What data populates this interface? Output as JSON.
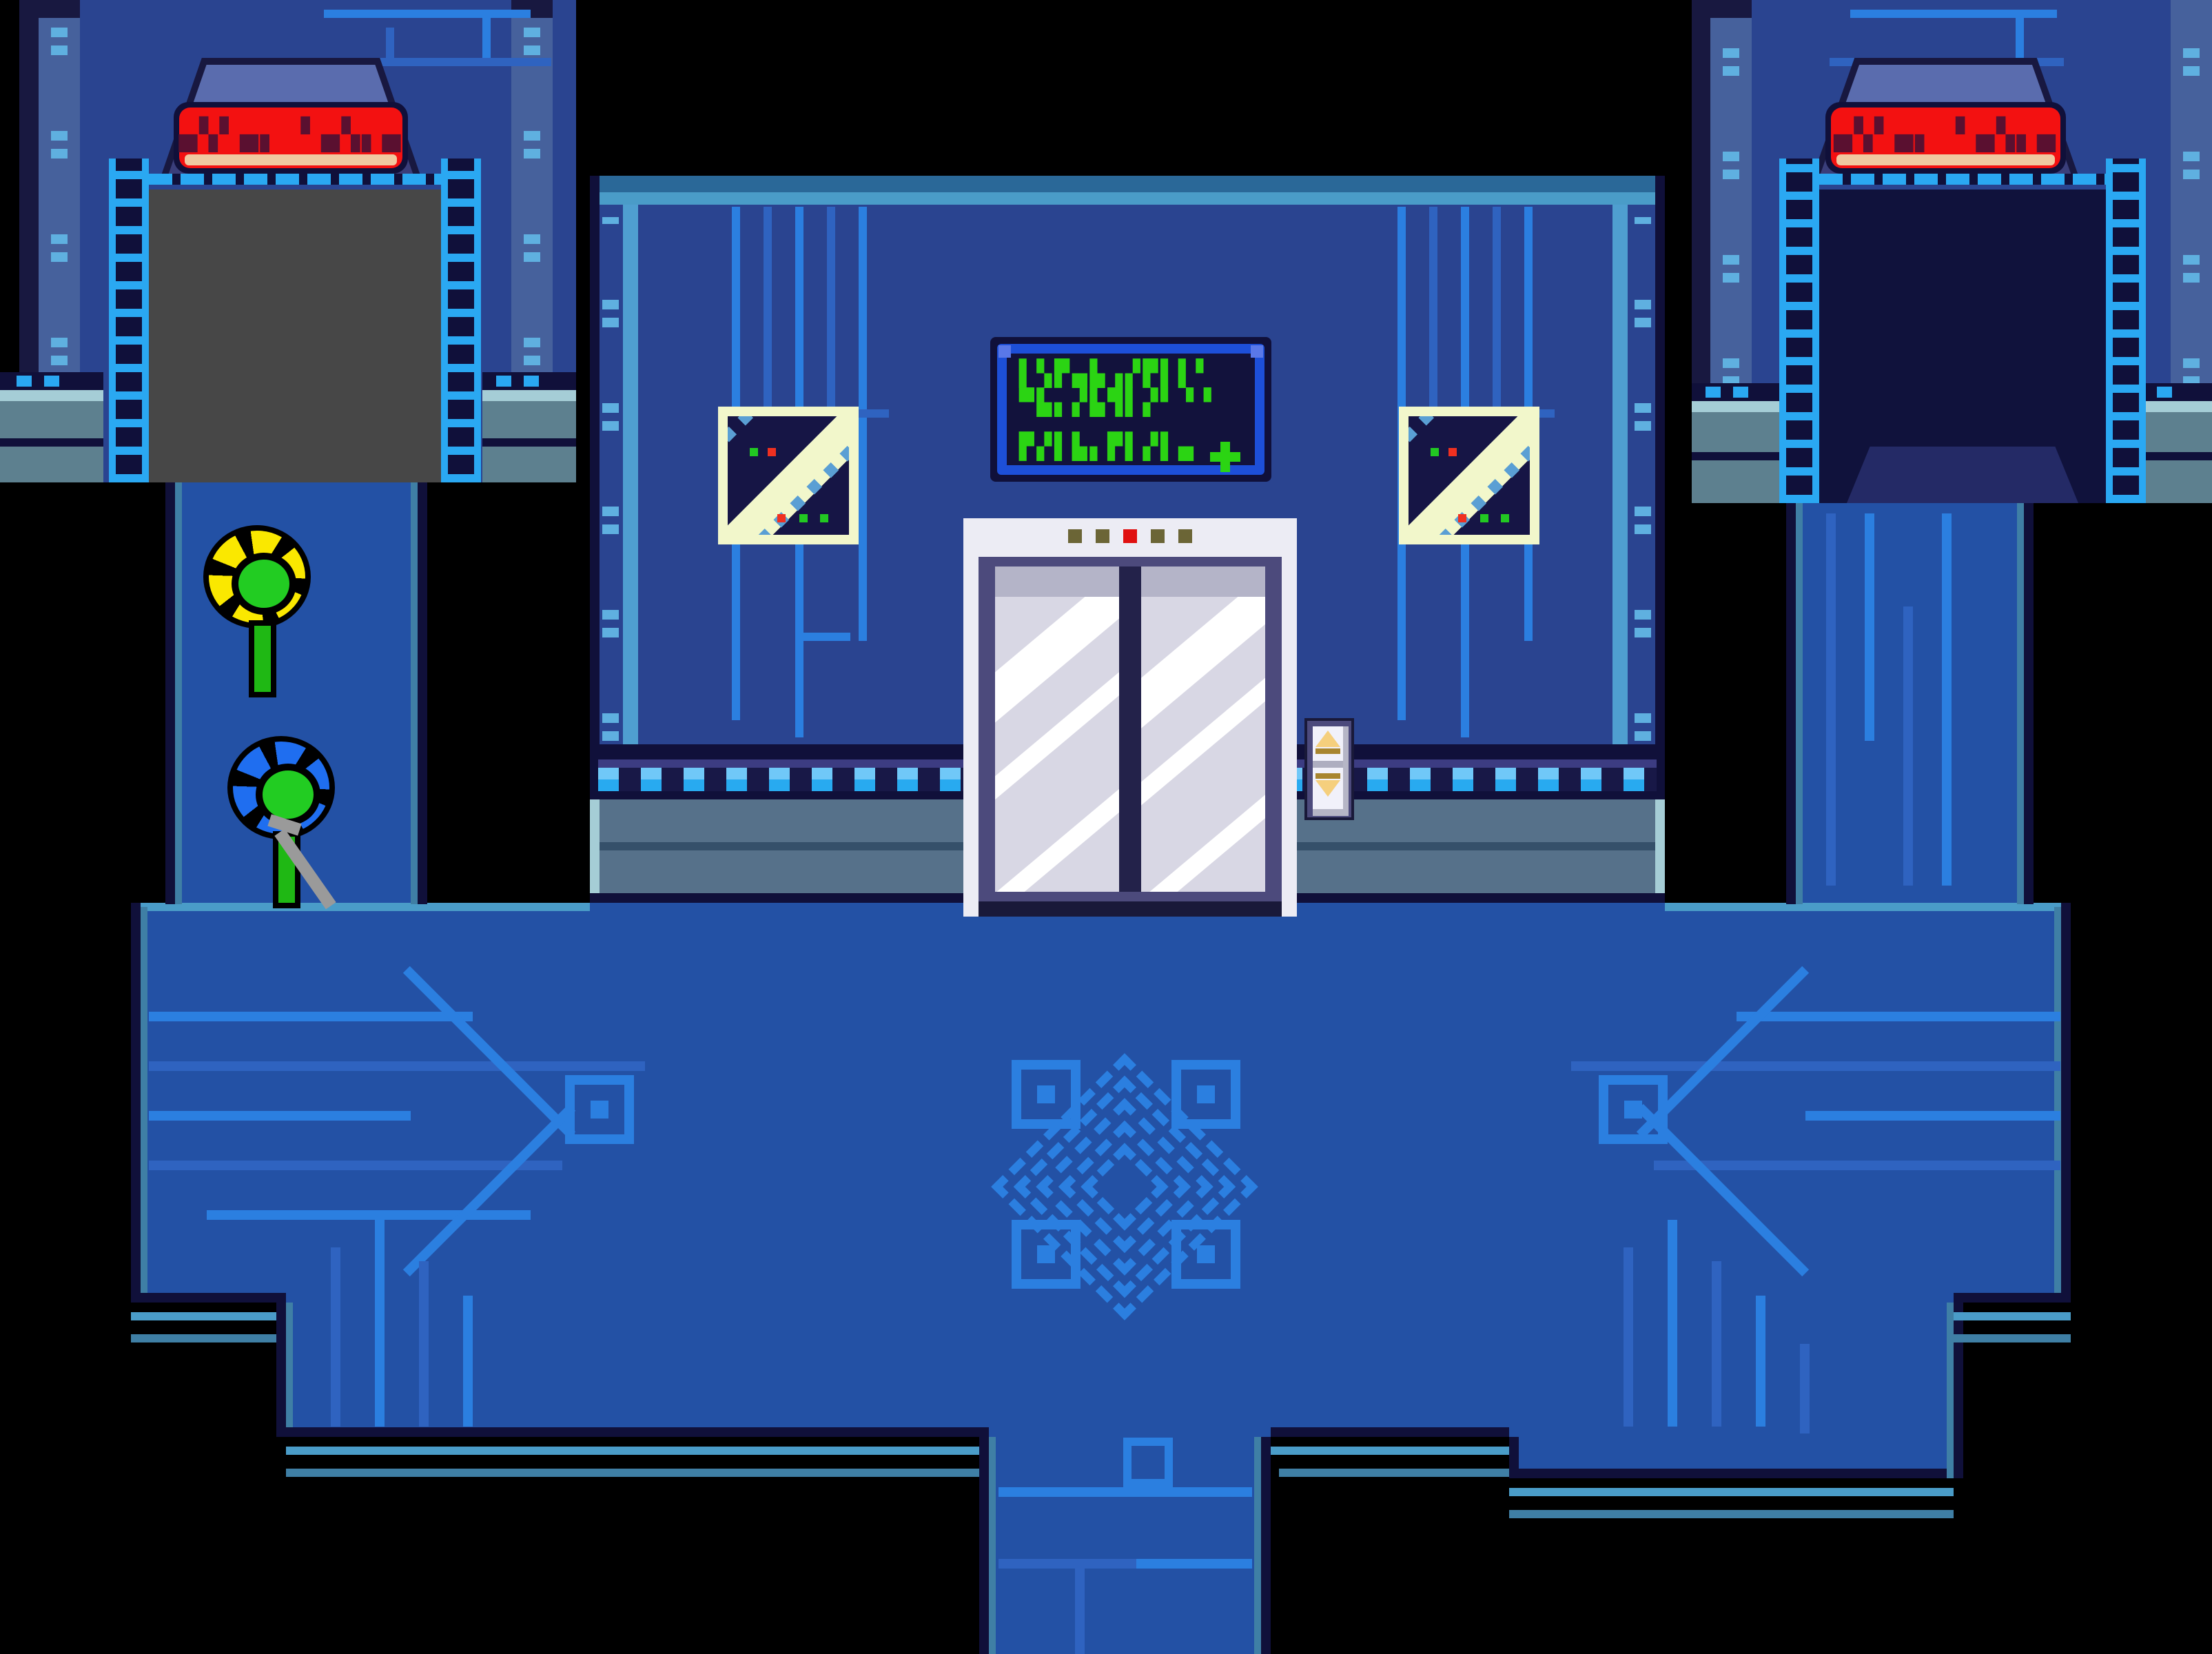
{
  "palette": {
    "bg": "#000000",
    "floor": "#2351a5",
    "trace": "#2b7fe0",
    "trace_dim": "#2f63c0",
    "edge_navy": "#10103a",
    "edge_teal": "#3f7fa5",
    "edge_light": "#4a9cc8",
    "wall": "#2a4490",
    "wall_top": "#2a6898",
    "pipe": "#4f9fd0",
    "pillar": "#46619c",
    "pillar_dark": "#181840",
    "rivet": "#5fb0e0",
    "arch_hi": "#5a6cae",
    "arch_mid": "#4a4e8e",
    "arch_lo": "#3a3e7a",
    "key_cyan": "#2aa8f2",
    "sign_red": "#f31111",
    "sign_glyph": "#5a1030",
    "sign_rim": "#f0c8a0",
    "door_gray": "#474747",
    "door_dark": "#10123c",
    "ramp": "#242a66",
    "term_border": "#1d4fd8",
    "term_screen": "#12123c",
    "term_green": "#2bd413",
    "win_frame": "#f2f7cb",
    "win_dark": "#161545",
    "win_blue": "#5a9fd4",
    "led_green": "#22c822",
    "led_red": "#f03020",
    "elev_frame": "#ececf4",
    "elev_purple": "#4c4a7c",
    "elev_panel": "#d8d7e4",
    "elev_panel_top": "#b4b4c8",
    "elev_gap": "#23224a",
    "shine": "#ffffff",
    "dot_olive": "#6b6536",
    "dot_red": "#e01010",
    "gold": "#f5cf7d",
    "gold_dark": "#a8852f",
    "btn_gray": "#aeaec0",
    "panel_white": "#f1f1fa",
    "trim_purple": "#3c3c82",
    "trim_navy": "#181847",
    "sq_hi": "#70c8f8",
    "sq_lo": "#28aaf0",
    "slate": "#56718a",
    "slate_dark": "#35506a",
    "slate_cap": "#a5cdd6",
    "base_slate": "#5d808f",
    "flower_yellow": "#fae800",
    "flower_blue": "#1f6ef0",
    "flower_green": "#22cc22",
    "stem_green": "#1fb814",
    "wrench_gray": "#9a9a9a"
  },
  "signs": {
    "led_text": "▄▚▘▄▖ ▘▄▚▖▄"
  },
  "terminal": {
    "lines": [
      "▌▚▛▄▙▗▞▛▌▌▘",
      "▀▙▖▞▙▜▌▞▘▝▝",
      "▛▞▌▙▖▛▌▞▌▄"
    ]
  },
  "elevator": {
    "indicator_dots": [
      "olive",
      "olive",
      "red",
      "olive",
      "olive"
    ],
    "call_buttons": [
      "up",
      "down"
    ]
  }
}
